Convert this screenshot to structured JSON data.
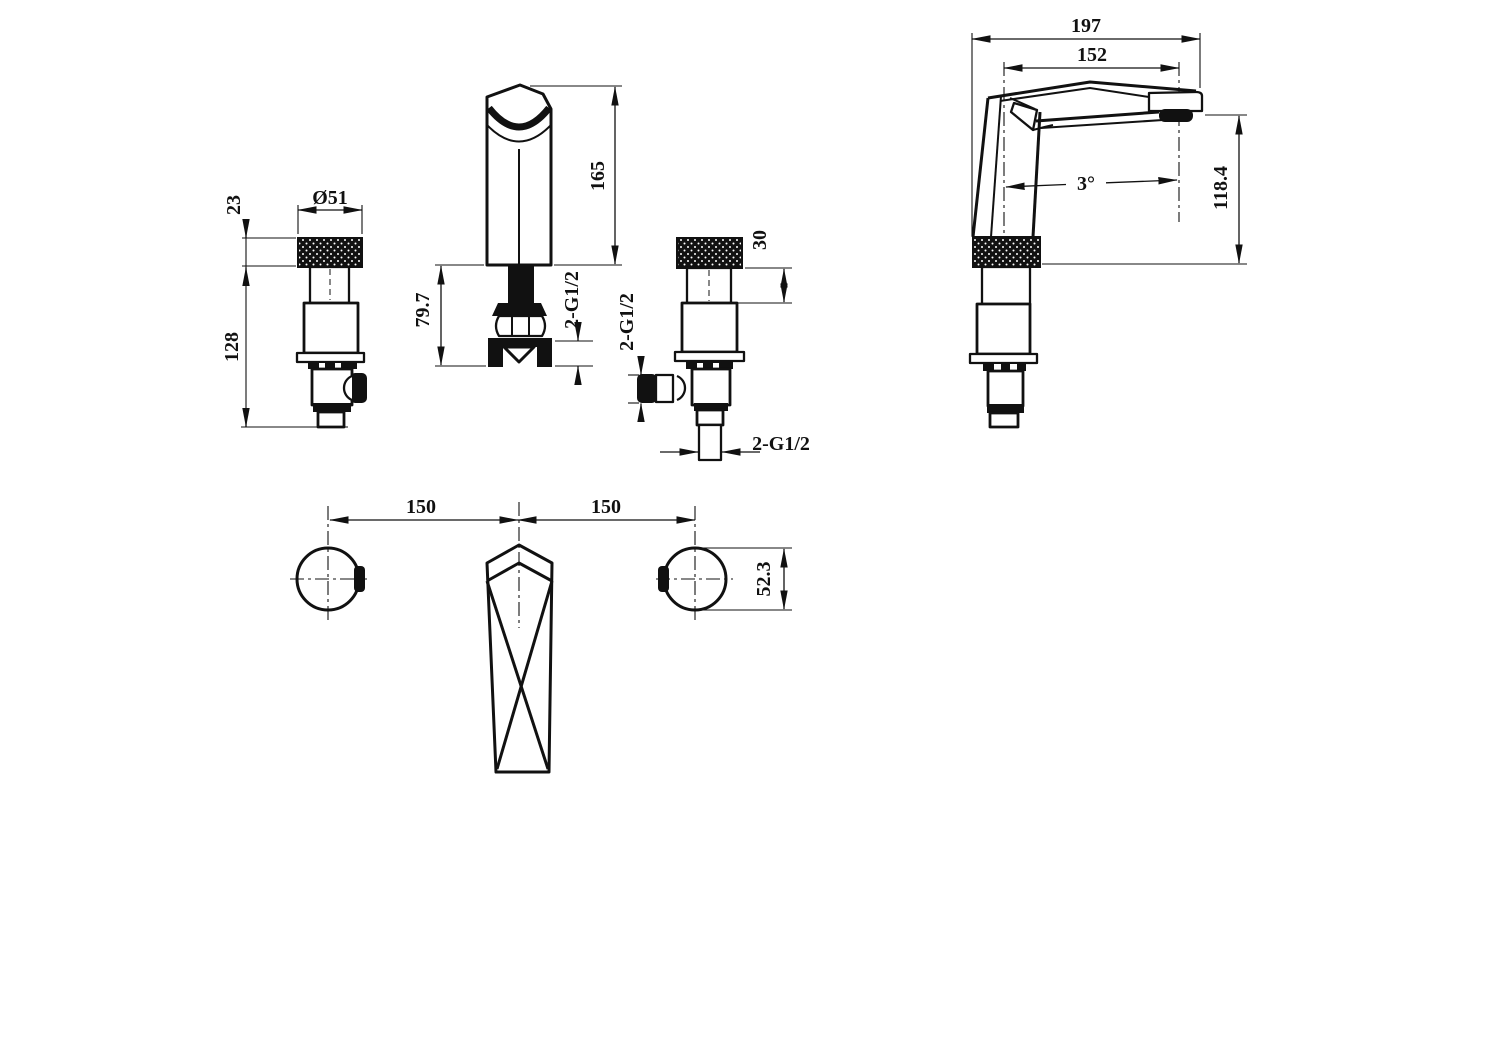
{
  "drawing": {
    "background": "#ffffff",
    "line_color": "#111111",
    "views": {
      "handle_front": {
        "name": "handle valve front view",
        "dims": {
          "knob_diameter": "Ø51",
          "knurl_height": "23",
          "under_body_height": "128"
        }
      },
      "spout_front": {
        "name": "spout front view",
        "dims": {
          "body_height": "165",
          "under_counter_length": "79.7",
          "side_ports_thread": "2-G1/2"
        }
      },
      "valve_front": {
        "name": "valve side view",
        "dims": {
          "collar_height": "30",
          "side_port_thread": "2-G1/2",
          "inlet_thread": "2-G1/2"
        }
      },
      "spout_side": {
        "name": "spout side view",
        "dims": {
          "overall_projection": "197",
          "spout_reach": "152",
          "tilt_angle": "3°",
          "outlet_height": "118.4"
        }
      },
      "plan": {
        "name": "installation plan view",
        "dims": {
          "left_center_spacing": "150",
          "right_center_spacing": "150",
          "handle_diameter": "52.3"
        }
      }
    }
  }
}
